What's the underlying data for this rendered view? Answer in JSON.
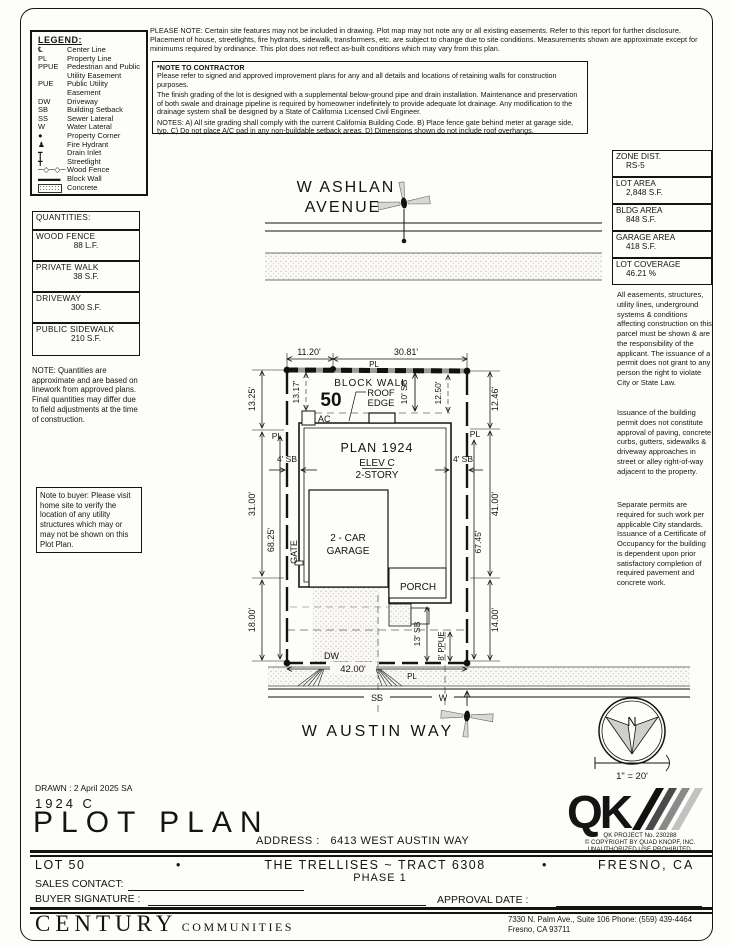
{
  "legend": {
    "title": "LEGEND:",
    "items": [
      {
        "symbol": "℄",
        "label": "Center Line"
      },
      {
        "symbol": "PL",
        "label": "Property Line"
      },
      {
        "symbol": "PPUE",
        "label": "Pedestrian and Public",
        "label2": "Utility Easement"
      },
      {
        "symbol": "PUE",
        "label": "Public Utility",
        "label2": "Easement"
      },
      {
        "symbol": "DW",
        "label": "Driveway"
      },
      {
        "symbol": "SB",
        "label": "Building Setback"
      },
      {
        "symbol": "SS",
        "label": "Sewer Lateral"
      },
      {
        "symbol": "W",
        "label": "Water Lateral"
      },
      {
        "symbol": "●",
        "label": "Property Corner"
      },
      {
        "symbol": "♟",
        "label": "Fire Hydrant"
      },
      {
        "symbol": "┳",
        "label": "Drain Inlet"
      },
      {
        "symbol": "╋",
        "label": "Streetlight"
      },
      {
        "symbol": "─◇─◇─",
        "label": "Wood Fence"
      },
      {
        "symbol": "▬▬▬",
        "label": "Block Wall"
      },
      {
        "symbol": "",
        "label": "Concrete"
      }
    ]
  },
  "notes": {
    "please_note": "PLEASE NOTE:  Certain site features may not be included in drawing.  Plot map may not note any or all existing easements.  Refer to this report for further disclosure.  Placement of house, streetlights, fire hydrants, sidewalk, transformers, etc. are subject to change due to site conditions.  Measurements shown are approximate except for minimums required by ordinance.  This plot does not reflect as-built conditions which may vary from this plan.",
    "contractor_title": "*NOTE TO CONTRACTOR",
    "contractor_p1": "Please refer to signed and approved improvement plans for any and all details and locations of retaining walls for construction purposes.",
    "contractor_p2": "The finish grading of the lot is designed with a supplemental below-ground pipe and drain installation.  Maintenance and preservation of both swale and drainage pipeline is required by homeowner indefinitely to provide adequate lot drainage.  Any modification to the drainage system shall be designed by a State of California Licensed Civil Engineer.",
    "contractor_p3": "NOTES:  A) All site grading shall comply with the current California Building Code.  B) Place fence gate behind meter at garage side, typ.  C) Do not place A/C pad in any non-buildable setback areas.  D) Dimensions shown do not include roof overhangs."
  },
  "quantities": {
    "title": "QUANTITIES:",
    "items": [
      {
        "name": "WOOD FENCE",
        "value": "88 L.F."
      },
      {
        "name": "PRIVATE WALK",
        "value": "38 S.F."
      },
      {
        "name": "DRIVEWAY",
        "value": "300 S.F."
      },
      {
        "name": "PUBLIC SIDEWALK",
        "value": "210 S.F."
      }
    ],
    "note": "NOTE: Quantities are approximate and are based on linework from approved plans.  Final quantities may differ due to field adjustments at the time of construction.",
    "buyer_note": "Note to buyer: Please visit home site to verify the location of any utility structures which may or may not be shown on this Plot Plan."
  },
  "site_data": {
    "items": [
      {
        "label": "ZONE DIST.",
        "value": "RS-5"
      },
      {
        "label": "LOT AREA",
        "value": "2,848 S.F."
      },
      {
        "label": "BLDG AREA",
        "value": "848 S.F."
      },
      {
        "label": "GARAGE AREA",
        "value": "418 S.F."
      },
      {
        "label": "LOT COVERAGE",
        "value": "46.21 %"
      }
    ],
    "p1": "All easements, structures, utility lines, underground systems & conditions affecting construction on this parcel must be shown & are the responsibility of the applicant. The issuance of a permit does not grant to any person the right to violate City or State Law.",
    "p2": "Issuance of the building permit does not constitute approval of paving, concrete curbs, gutters, sidewalks & driveway approaches in street or alley right-of-way adjacent to the property.",
    "p3": "Separate permits are required for such work per applicable City standards. Issuance of a Certificate of Occupancy for the building is dependent upon prior satisfactory completion of required pavement and concrete work."
  },
  "plan": {
    "street_top_line1": "W ASHLAN",
    "street_top_line2": "AVENUE",
    "street_bottom": "W AUSTIN WAY",
    "lot_number": "50",
    "block_wall_label": "BLOCK WALL",
    "roof_edge_line1": "ROOF",
    "roof_edge_line2": "EDGE",
    "ac_label": "AC",
    "plan_name": "PLAN 1924",
    "elevation": "ELEV C",
    "stories": "2-STORY",
    "garage_line1": "2 - CAR",
    "garage_line2": "GARAGE",
    "porch_label": "PORCH",
    "gate_label": "GATE",
    "dw_label": "DW",
    "pl_label": "PL",
    "ss_label": "SS",
    "w_label": "W",
    "north_label": "N",
    "scale_label": "1\" = 20'",
    "dims": {
      "front_left": "11.20'",
      "front_right": "30.81'",
      "left_top": "13.25'",
      "left_mid": "31.00'",
      "left_bottom": "18.00'",
      "left_overall": "68.25'",
      "right_top": "12.46'",
      "right_mid": "41.00'",
      "right_bottom": "14.00'",
      "right_overall": "67.45'",
      "frontage": "42.00'",
      "side_sb_left": "4' SB",
      "side_sb_right": "4' SB",
      "rear_sb": "10' SB",
      "rear_left": "13.17'",
      "rear_right": "12.50'",
      "front_sb": "13' SB",
      "ppue": "8' PPUE"
    }
  },
  "title_block": {
    "drawn": "DRAWN :  2 April 2025  SA",
    "plan_code": "1924  C",
    "title": "PLOT PLAN",
    "address_label": "ADDRESS :",
    "address_value": "6413 WEST AUSTIN WAY",
    "lot": "LOT 50",
    "bullet": "•",
    "tract": "THE TRELLISES ~ TRACT 6308",
    "phase": "PHASE 1",
    "city": "FRESNO, CA",
    "sales_contact_label": "SALES CONTACT:",
    "buyer_signature_label": "BUYER SIGNATURE :",
    "approval_date_label": "APPROVAL DATE :"
  },
  "qk": {
    "wordmark": "QK",
    "project": "QK PROJECT No. 230288",
    "copyright": "© COPYRIGHT BY QUAD KNOPF, INC.",
    "rights": "UNAUTHORIZED USE PROHIBITED."
  },
  "footer": {
    "brand": "CENTURY",
    "brand2": "COMMUNITIES",
    "addr1": "7330 N. Palm Ave., Suite 106    Phone:  (559) 439-4464",
    "addr2": "Fresno, CA  93711"
  }
}
